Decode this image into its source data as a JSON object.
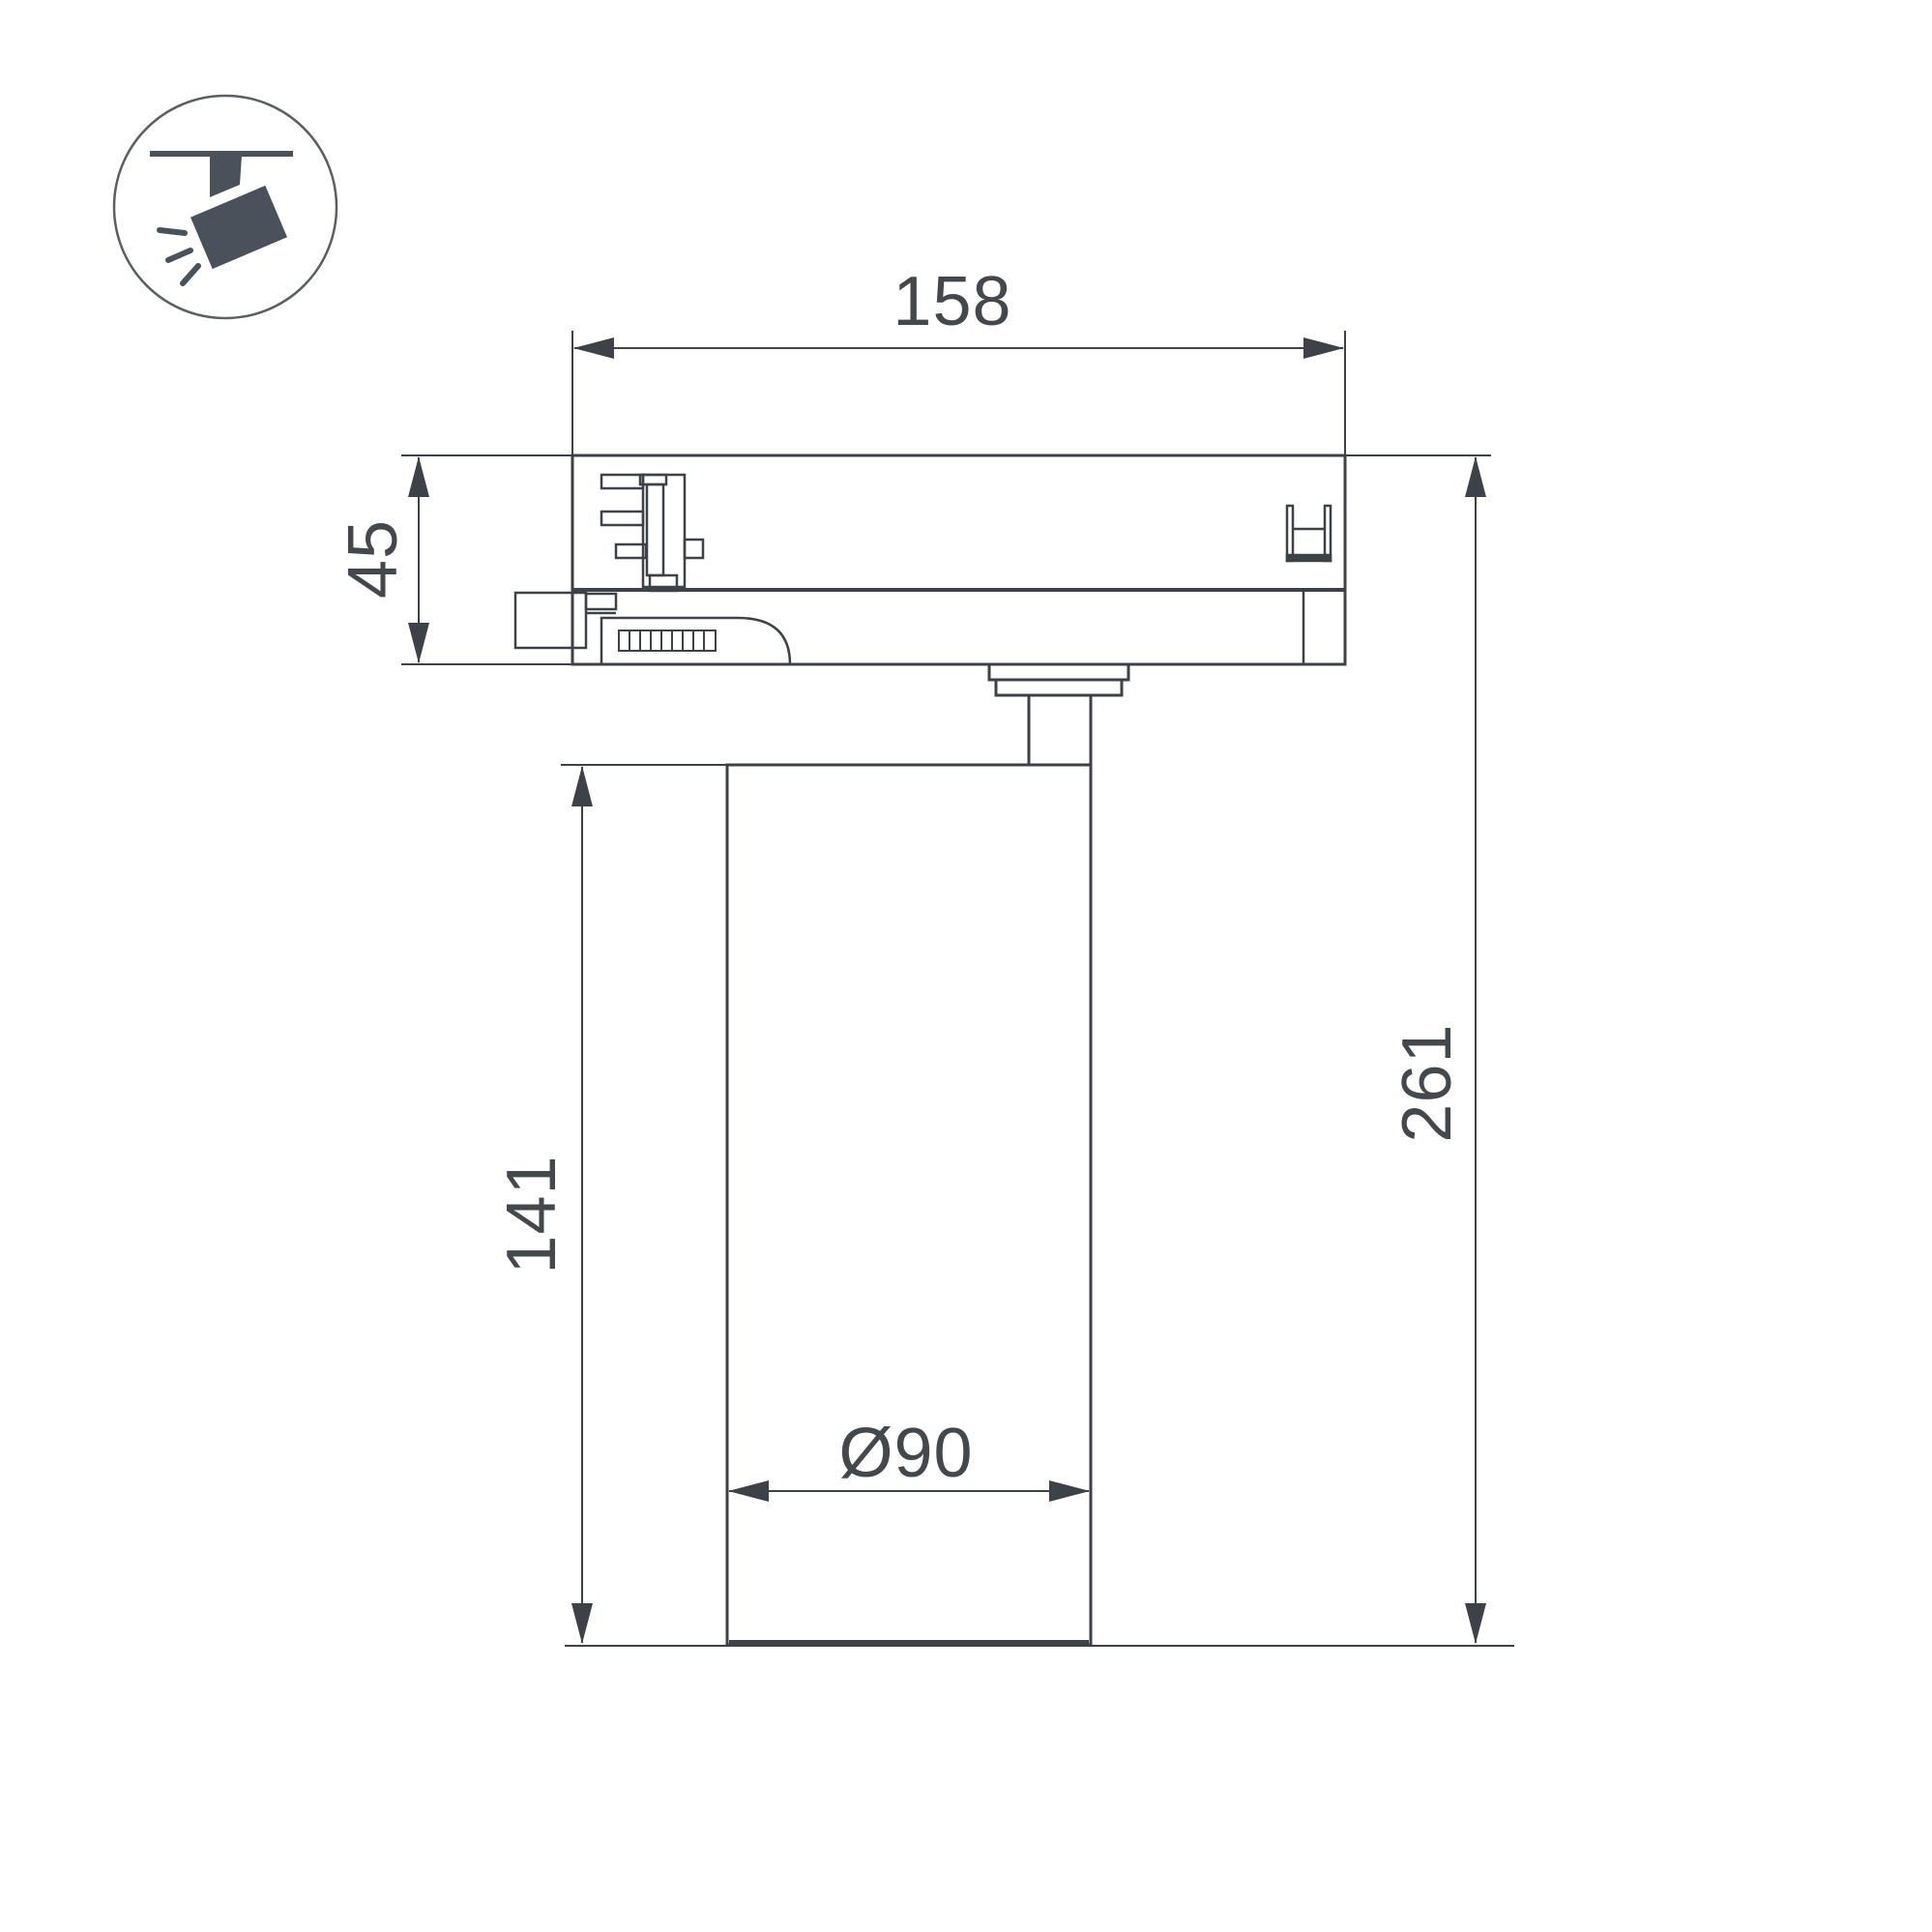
{
  "drawing": {
    "type": "track-spotlight-dimensional-drawing",
    "dimensions": {
      "adapter_width_mm": "158",
      "adapter_height_mm": "45",
      "body_height_mm": "141",
      "overall_height_mm": "261",
      "body_diameter_mm": "Ø90"
    },
    "icon": "ceiling-track-spotlight",
    "colors": {
      "line": "#3d4248",
      "icon_fill": "#49525a",
      "background": "#ffffff"
    }
  }
}
